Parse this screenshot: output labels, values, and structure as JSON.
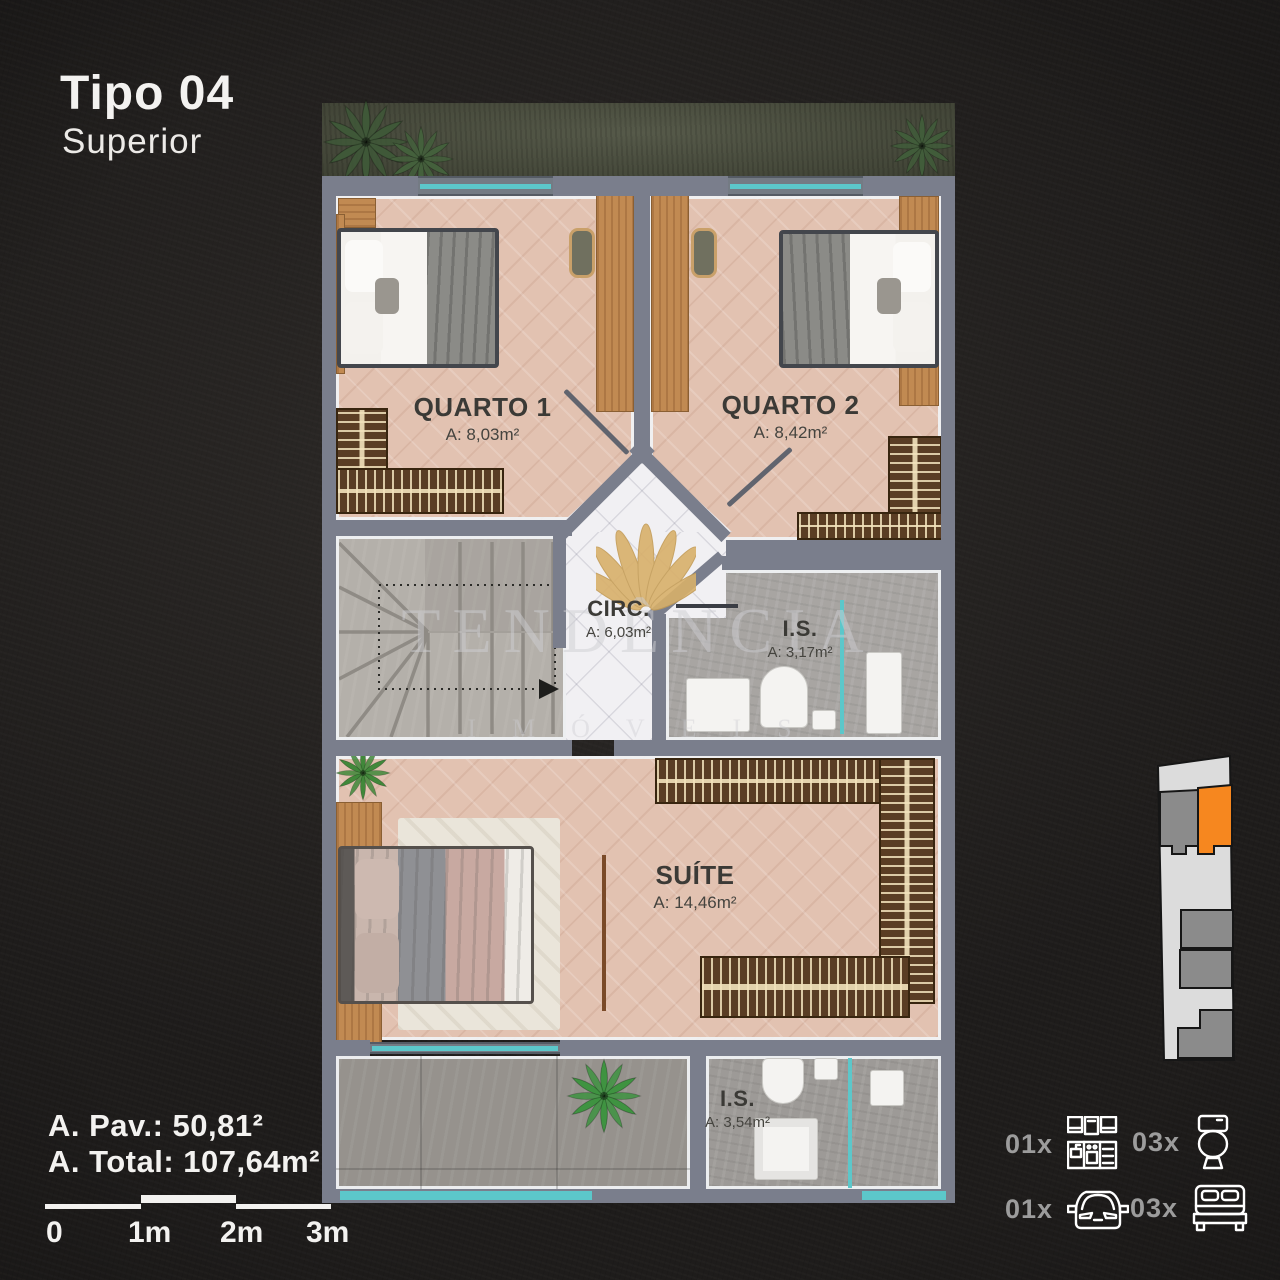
{
  "title": {
    "name": "Tipo 04",
    "subtitle": "Superior"
  },
  "plan": {
    "rooms": [
      {
        "key": "quarto1",
        "label": "QUARTO 1",
        "area": "A: 8,03m²"
      },
      {
        "key": "quarto2",
        "label": "QUARTO 2",
        "area": "A: 8,42m²"
      },
      {
        "key": "circ",
        "label": "CIRC.",
        "area": "A: 6,03m²"
      },
      {
        "key": "is_superior",
        "label": "I.S.",
        "area": "A: 3,17m²"
      },
      {
        "key": "suite",
        "label": "SUÍTE",
        "area": "A: 14,46m²"
      },
      {
        "key": "is_suite",
        "label": "I.S.",
        "area": "A: 3,54m²"
      }
    ]
  },
  "summary": {
    "pavement_area": "A. Pav.: 50,81²",
    "total_area": "A. Total: 107,64m²"
  },
  "scale_bar": {
    "labels": [
      "0",
      "1m",
      "2m",
      "3m"
    ]
  },
  "legend": {
    "items": [
      {
        "icon": "kitchen-icon",
        "count": "01x"
      },
      {
        "icon": "toilet-icon",
        "count": "03x"
      },
      {
        "icon": "car-icon",
        "count": "01x"
      },
      {
        "icon": "bed-icon",
        "count": "03x"
      }
    ]
  },
  "watermark": {
    "brand": "TENDÊNCIA",
    "segment": "IMÓVEIS"
  },
  "colors": {
    "background": "#1E1C1B",
    "accent_orange": "#F6871F",
    "wall_gray": "#7A7E8C",
    "glass_cyan": "#5CC7CA",
    "wood": "#C18A52",
    "floor_pink": "#E2C2B1",
    "count_gray": "#9C9C9C"
  }
}
